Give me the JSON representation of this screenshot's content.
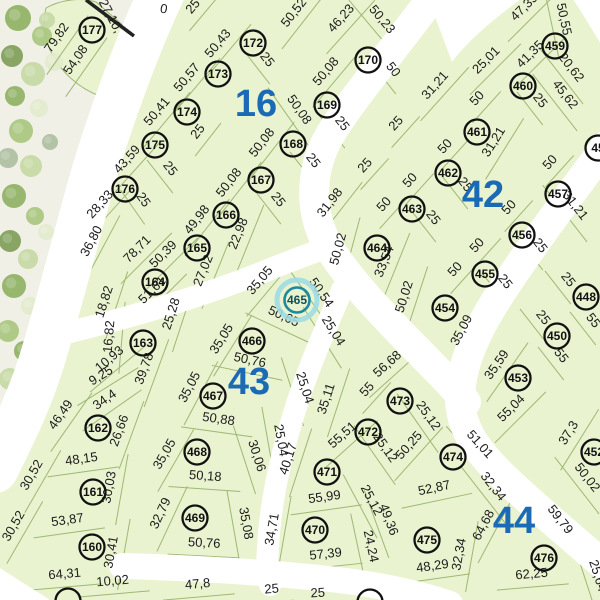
{
  "map": {
    "title": "cadastral-plat-map",
    "selected_parcel": "465",
    "colors": {
      "lot_fill": "#e9f3cf",
      "lot_line": "#9fb873",
      "road": "#ffffff",
      "ground": "#f0f0e6",
      "dim_text": "#1d1d1d",
      "parcel_stroke": "#111111",
      "parcel_text": "#111111",
      "block_label": "#1a6ab5",
      "selected_ring": "#1b8a9e",
      "selected_halo": "#9fdbe3",
      "selected_text": "#114f58",
      "boundary": "#222222",
      "tree_palette": [
        "#8fb164",
        "#a9c77f",
        "#c6d9a3",
        "#e2ebcc",
        "#aebfa0",
        "#7f9e58"
      ]
    },
    "blocks": [
      {
        "label": "16",
        "x": 256,
        "y": 116
      },
      {
        "label": "42",
        "x": 483,
        "y": 207
      },
      {
        "label": "43",
        "x": 249,
        "y": 394
      },
      {
        "label": "44",
        "x": 514,
        "y": 533
      }
    ],
    "parcels": [
      {
        "num": "177",
        "x": 92,
        "y": 30
      },
      {
        "num": "172",
        "x": 253,
        "y": 43
      },
      {
        "num": "173",
        "x": 218,
        "y": 74
      },
      {
        "num": "170",
        "x": 368,
        "y": 60
      },
      {
        "num": "174",
        "x": 187,
        "y": 112
      },
      {
        "num": "169",
        "x": 327,
        "y": 105
      },
      {
        "num": "175",
        "x": 155,
        "y": 145
      },
      {
        "num": "168",
        "x": 293,
        "y": 144
      },
      {
        "num": "176",
        "x": 125,
        "y": 189
      },
      {
        "num": "167",
        "x": 261,
        "y": 180
      },
      {
        "num": "166",
        "x": 226,
        "y": 215
      },
      {
        "num": "165",
        "x": 197,
        "y": 248
      },
      {
        "num": "164",
        "x": 155,
        "y": 282
      },
      {
        "num": "163",
        "x": 143,
        "y": 343
      },
      {
        "num": "162",
        "x": 98,
        "y": 428
      },
      {
        "num": "161",
        "x": 93,
        "y": 492
      },
      {
        "num": "160",
        "x": 92,
        "y": 547
      },
      {
        "num": "465",
        "x": 297,
        "y": 300,
        "selected": true
      },
      {
        "num": "466",
        "x": 252,
        "y": 341
      },
      {
        "num": "467",
        "x": 213,
        "y": 396
      },
      {
        "num": "468",
        "x": 197,
        "y": 452
      },
      {
        "num": "469",
        "x": 195,
        "y": 518
      },
      {
        "num": "470",
        "x": 315,
        "y": 530
      },
      {
        "num": "471",
        "x": 327,
        "y": 472
      },
      {
        "num": "472",
        "x": 368,
        "y": 432
      },
      {
        "num": "473",
        "x": 400,
        "y": 401
      },
      {
        "num": "474",
        "x": 453,
        "y": 457
      },
      {
        "num": "475",
        "x": 427,
        "y": 540
      },
      {
        "num": "476",
        "x": 544,
        "y": 558
      },
      {
        "num": "459",
        "x": 555,
        "y": 46
      },
      {
        "num": "460",
        "x": 523,
        "y": 86
      },
      {
        "num": "461",
        "x": 477,
        "y": 132
      },
      {
        "num": "462",
        "x": 448,
        "y": 173
      },
      {
        "num": "463",
        "x": 412,
        "y": 209
      },
      {
        "num": "464",
        "x": 377,
        "y": 248
      },
      {
        "num": "457",
        "x": 558,
        "y": 194
      },
      {
        "num": "456",
        "x": 522,
        "y": 235
      },
      {
        "num": "455",
        "x": 485,
        "y": 274
      },
      {
        "num": "454",
        "x": 445,
        "y": 308
      },
      {
        "num": "448",
        "x": 586,
        "y": 297
      },
      {
        "num": "450",
        "x": 557,
        "y": 336
      },
      {
        "num": "453",
        "x": 518,
        "y": 378
      },
      {
        "num": "452",
        "x": 594,
        "y": 452
      },
      {
        "num": "45",
        "x": 598,
        "y": 148
      },
      {
        "num": "",
        "x": 68,
        "y": 601
      },
      {
        "num": "",
        "x": 370,
        "y": 602
      }
    ],
    "dimensions": [
      [
        "27,10,",
        107,
        18,
        62
      ],
      [
        "0",
        163,
        13,
        10
      ],
      [
        "79,82",
        60,
        40,
        -55
      ],
      [
        "54,08",
        79,
        62,
        -55
      ],
      [
        "25",
        196,
        9,
        -50
      ],
      [
        "50,52",
        297,
        15,
        -52
      ],
      [
        "46,23",
        344,
        21,
        -48
      ],
      [
        "50,23",
        379,
        22,
        50
      ],
      [
        "50,43",
        221,
        46,
        -50
      ],
      [
        "25",
        264,
        62,
        52
      ],
      [
        "50,57",
        190,
        80,
        -50
      ],
      [
        "50,08",
        329,
        74,
        -50
      ],
      [
        "50",
        390,
        72,
        52
      ],
      [
        "50,41",
        160,
        114,
        -50
      ],
      [
        "25",
        201,
        134,
        -52
      ],
      [
        "50,08",
        296,
        112,
        55
      ],
      [
        "25",
        339,
        126,
        52
      ],
      [
        "25",
        399,
        126,
        -48
      ],
      [
        "43,59",
        130,
        162,
        -48
      ],
      [
        "25",
        167,
        171,
        52
      ],
      [
        "50,08",
        265,
        145,
        -52
      ],
      [
        "25",
        310,
        163,
        52
      ],
      [
        "28,33",
        103,
        207,
        -48
      ],
      [
        "25",
        140,
        202,
        55
      ],
      [
        "50,08",
        232,
        185,
        -52
      ],
      [
        "25",
        275,
        202,
        52
      ],
      [
        "36,80",
        95,
        243,
        -62
      ],
      [
        "49,98",
        200,
        222,
        -52
      ],
      [
        "22,98",
        242,
        235,
        -68
      ],
      [
        "78,71",
        140,
        252,
        -45
      ],
      [
        "50,39",
        166,
        257,
        -45
      ],
      [
        "27,02",
        207,
        272,
        -68
      ],
      [
        "51,61",
        155,
        293,
        -45
      ],
      [
        "18,82",
        108,
        303,
        -72
      ],
      [
        "16,82",
        113,
        337,
        -85
      ],
      [
        "25,28",
        175,
        315,
        -72
      ],
      [
        "10,93",
        112,
        362,
        -40
      ],
      [
        "9,25",
        103,
        379,
        -32
      ],
      [
        "39,78",
        148,
        370,
        -70
      ],
      [
        "34,4",
        107,
        403,
        -35
      ],
      [
        "46,49",
        64,
        417,
        -55
      ],
      [
        "26,66",
        123,
        432,
        -70
      ],
      [
        "48,15",
        82,
        463,
        -8
      ],
      [
        "30,52",
        35,
        477,
        -60
      ],
      [
        "30,03",
        113,
        488,
        -80
      ],
      [
        "53,87",
        68,
        524,
        -8
      ],
      [
        "30,52",
        17,
        528,
        -60
      ],
      [
        "30,41",
        115,
        553,
        -80
      ],
      [
        "64,31",
        65,
        578,
        -5
      ],
      [
        "10,02",
        113,
        585,
        -5
      ],
      [
        "35,05",
        263,
        283,
        -50
      ],
      [
        "50,54",
        318,
        295,
        55
      ],
      [
        "50,65",
        282,
        320,
        25
      ],
      [
        "25,04",
        330,
        333,
        58
      ],
      [
        "35,05",
        225,
        341,
        -58
      ],
      [
        "50,76",
        249,
        364,
        12
      ],
      [
        "25,04",
        301,
        389,
        72
      ],
      [
        "35,05",
        193,
        389,
        -62
      ],
      [
        "50,88",
        218,
        423,
        8
      ],
      [
        "25,04",
        277,
        441,
        80
      ],
      [
        "35,11",
        330,
        400,
        -72
      ],
      [
        "35,05",
        168,
        456,
        -60
      ],
      [
        "50,18",
        205,
        480,
        4
      ],
      [
        "30,06",
        253,
        457,
        72
      ],
      [
        "32,79",
        164,
        515,
        -65
      ],
      [
        "50,76",
        204,
        547,
        3
      ],
      [
        "35,08",
        242,
        524,
        80
      ],
      [
        "40,17",
        292,
        460,
        -72
      ],
      [
        "55,51",
        345,
        438,
        -42
      ],
      [
        "25,12",
        382,
        450,
        55
      ],
      [
        "56,68",
        390,
        367,
        -42
      ],
      [
        "55",
        370,
        392,
        -48
      ],
      [
        "25,12",
        425,
        418,
        55
      ],
      [
        "25,12",
        368,
        502,
        62
      ],
      [
        "50,25",
        412,
        448,
        -48
      ],
      [
        "51,01",
        477,
        447,
        48
      ],
      [
        "55,99",
        325,
        501,
        -8
      ],
      [
        "34,71",
        276,
        530,
        -80
      ],
      [
        "57,39",
        326,
        558,
        -6
      ],
      [
        "24,24",
        367,
        547,
        78
      ],
      [
        "49,36",
        385,
        521,
        70
      ],
      [
        "52,87",
        435,
        492,
        -12
      ],
      [
        "32,34",
        490,
        489,
        52
      ],
      [
        "64,68",
        487,
        527,
        -62
      ],
      [
        "32,34",
        463,
        555,
        -80
      ],
      [
        "48,29",
        433,
        570,
        -8
      ],
      [
        "59,79",
        557,
        522,
        52
      ],
      [
        "62,25",
        532,
        578,
        -5
      ],
      [
        "25,64",
        594,
        577,
        72
      ],
      [
        "50,02",
        584,
        480,
        52
      ],
      [
        "37,3",
        572,
        435,
        -58
      ],
      [
        "31,21",
        438,
        88,
        -48
      ],
      [
        "25,01",
        489,
        63,
        -45
      ],
      [
        "47,35",
        527,
        10,
        -45
      ],
      [
        "50,55",
        560,
        20,
        78
      ],
      [
        "41,35",
        533,
        57,
        -45
      ],
      [
        "20,62",
        568,
        70,
        52
      ],
      [
        "50",
        480,
        101,
        -48
      ],
      [
        "25",
        537,
        103,
        52
      ],
      [
        "45,62",
        562,
        97,
        52
      ],
      [
        "31,21",
        497,
        144,
        -58
      ],
      [
        "50",
        448,
        149,
        -48
      ],
      [
        "50",
        553,
        165,
        -48
      ],
      [
        "25",
        368,
        168,
        -48
      ],
      [
        "50",
        413,
        183,
        -48
      ],
      [
        "25",
        462,
        187,
        52
      ],
      [
        "31,21",
        572,
        208,
        52
      ],
      [
        "31,98",
        333,
        205,
        -52
      ],
      [
        "50",
        387,
        207,
        -48
      ],
      [
        "25",
        430,
        220,
        52
      ],
      [
        "50",
        512,
        210,
        -48
      ],
      [
        "50,02",
        342,
        250,
        -75
      ],
      [
        "33,54",
        388,
        263,
        -68
      ],
      [
        "50",
        480,
        248,
        -48
      ],
      [
        "25",
        537,
        248,
        52
      ],
      [
        "50",
        458,
        272,
        -48
      ],
      [
        "25",
        502,
        284,
        52
      ],
      [
        "25",
        565,
        282,
        52
      ],
      [
        "35,09",
        465,
        332,
        -62
      ],
      [
        "50,02",
        408,
        298,
        -72
      ],
      [
        "55",
        590,
        323,
        52
      ],
      [
        "25",
        540,
        320,
        52
      ],
      [
        "55",
        558,
        358,
        52
      ],
      [
        "35,59",
        500,
        367,
        -55
      ],
      [
        "55,04",
        514,
        411,
        -45
      ],
      [
        "47,8",
        198,
        588,
        -5
      ],
      [
        "25",
        272,
        593,
        -5
      ],
      [
        "25",
        318,
        597,
        -3
      ]
    ],
    "boundary_segment": {
      "x1": 86,
      "y1": 0,
      "x2": 134,
      "y2": 36
    },
    "trees": [
      [
        18,
        18,
        13,
        0
      ],
      [
        42,
        36,
        10,
        1
      ],
      [
        12,
        56,
        11,
        5
      ],
      [
        33,
        74,
        12,
        2
      ],
      [
        15,
        96,
        10,
        0
      ],
      [
        39,
        108,
        9,
        3
      ],
      [
        21,
        131,
        12,
        1
      ],
      [
        8,
        158,
        10,
        4
      ],
      [
        31,
        166,
        11,
        2
      ],
      [
        14,
        196,
        12,
        0
      ],
      [
        35,
        216,
        9,
        1
      ],
      [
        10,
        241,
        11,
        5
      ],
      [
        28,
        259,
        10,
        2
      ],
      [
        14,
        286,
        12,
        0
      ],
      [
        30,
        306,
        9,
        3
      ],
      [
        8,
        331,
        11,
        1
      ],
      [
        24,
        351,
        10,
        0
      ],
      [
        10,
        379,
        11,
        2
      ],
      [
        26,
        399,
        9,
        5
      ],
      [
        6,
        421,
        10,
        1
      ],
      [
        20,
        441,
        9,
        4
      ],
      [
        47,
        20,
        8,
        2
      ],
      [
        54,
        62,
        9,
        3
      ],
      [
        50,
        142,
        8,
        4
      ],
      [
        46,
        232,
        8,
        3
      ],
      [
        42,
        322,
        8,
        2
      ]
    ]
  }
}
